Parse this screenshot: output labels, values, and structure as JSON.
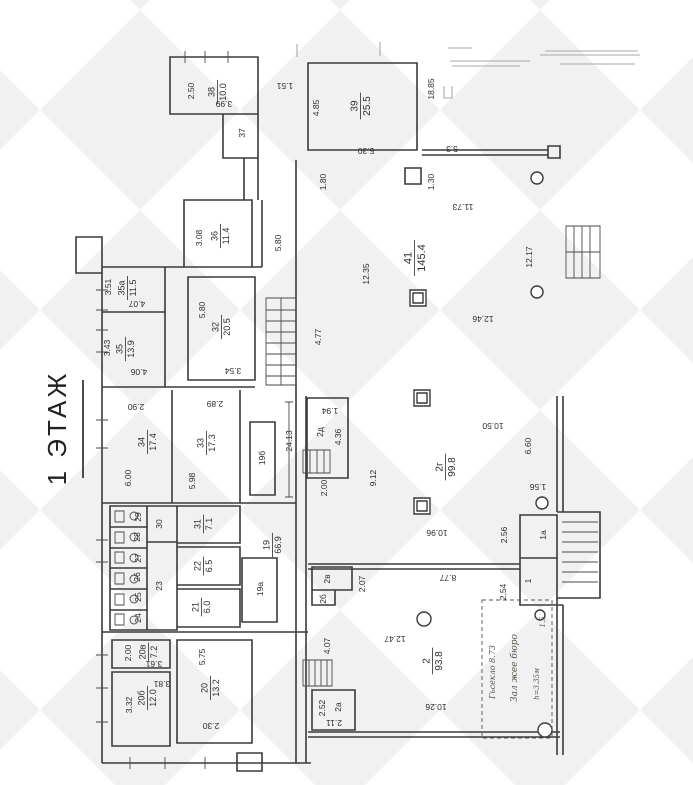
{
  "title": "1 ЭТАЖ",
  "colors": {
    "highlight": "#e5380e",
    "wall": "#3a3a3a",
    "paper": "#ffffff",
    "watermark": "#f1f1f1"
  },
  "highlights": {
    "rooms": [
      "39",
      "41"
    ],
    "stairwell_marked": true
  },
  "rooms": [
    {
      "id": "38",
      "num": "38",
      "area": "10.0"
    },
    {
      "id": "39",
      "num": "39",
      "area": "25.5"
    },
    {
      "id": "36",
      "num": "36",
      "area": "11.4"
    },
    {
      "id": "35a",
      "num": "35а",
      "area": "11.5"
    },
    {
      "id": "35",
      "num": "35",
      "area": "13.9"
    },
    {
      "id": "32",
      "num": "32",
      "area": "20.5"
    },
    {
      "id": "34",
      "num": "34",
      "area": "17.4"
    },
    {
      "id": "33",
      "num": "33",
      "area": "17.3"
    },
    {
      "id": "41",
      "num": "41",
      "area": "145.4"
    },
    {
      "id": "31",
      "num": "31",
      "area": "7.1"
    },
    {
      "id": "22",
      "num": "22",
      "area": "6.5"
    },
    {
      "id": "21",
      "num": "21",
      "area": "6.0"
    },
    {
      "id": "19",
      "num": "19",
      "area": "66.9"
    },
    {
      "id": "20v",
      "num": "20в",
      "area": "7.2"
    },
    {
      "id": "20b",
      "num": "20б",
      "area": "12.0"
    },
    {
      "id": "20",
      "num": "20",
      "area": "13.2"
    },
    {
      "id": "2g",
      "num": "2г",
      "area": "99.8"
    },
    {
      "id": "2",
      "num": "2",
      "area": "93.8"
    }
  ],
  "marks": [
    {
      "text": "2.50"
    },
    {
      "text": "3.99"
    },
    {
      "text": "1.51"
    },
    {
      "text": "37"
    },
    {
      "text": "4.85"
    },
    {
      "text": "5.30"
    },
    {
      "text": "18.85"
    },
    {
      "text": "5.3"
    },
    {
      "text": "3.08"
    },
    {
      "text": "5.80"
    },
    {
      "text": "3.51"
    },
    {
      "text": "4.07"
    },
    {
      "text": "3.43"
    },
    {
      "text": "4.06"
    },
    {
      "text": "5.80"
    },
    {
      "text": "3.54"
    },
    {
      "text": "2.90"
    },
    {
      "text": "6.00"
    },
    {
      "text": "2.89"
    },
    {
      "text": "5.98"
    },
    {
      "text": "12.35"
    },
    {
      "text": "4.77"
    },
    {
      "text": "1.80"
    },
    {
      "text": "1.30"
    },
    {
      "text": "11.73"
    },
    {
      "text": "12.17"
    },
    {
      "text": "12.46"
    },
    {
      "text": "19б"
    },
    {
      "text": "24.13"
    },
    {
      "text": "30"
    },
    {
      "text": "29"
    },
    {
      "text": "28"
    },
    {
      "text": "27"
    },
    {
      "text": "26"
    },
    {
      "text": "25"
    },
    {
      "text": "24"
    },
    {
      "text": "23"
    },
    {
      "text": "19а"
    },
    {
      "text": "2.00"
    },
    {
      "text": "3.61"
    },
    {
      "text": "5.75"
    },
    {
      "text": "3.81"
    },
    {
      "text": "3.32"
    },
    {
      "text": "2.30"
    },
    {
      "text": "2д"
    },
    {
      "text": "1.94"
    },
    {
      "text": "4.36"
    },
    {
      "text": "2.00"
    },
    {
      "text": "9.12"
    },
    {
      "text": "10.50"
    },
    {
      "text": "6.60"
    },
    {
      "text": "1.56"
    },
    {
      "text": "10.96"
    },
    {
      "text": "2.56"
    },
    {
      "text": "1а"
    },
    {
      "text": "1"
    },
    {
      "text": "2.54"
    },
    {
      "text": "2в"
    },
    {
      "text": "2б"
    },
    {
      "text": "2.07"
    },
    {
      "text": "8.77"
    },
    {
      "text": "12.47"
    },
    {
      "text": "4.07"
    },
    {
      "text": "10.26"
    },
    {
      "text": "2а"
    },
    {
      "text": "2.52"
    },
    {
      "text": "2.11"
    }
  ],
  "notes": [
    {
      "text": "Гьсекло 8.73"
    },
    {
      "text": "Зал жее бюро"
    },
    {
      "text": "h=3.35м"
    },
    {
      "text": "1.5"
    }
  ]
}
